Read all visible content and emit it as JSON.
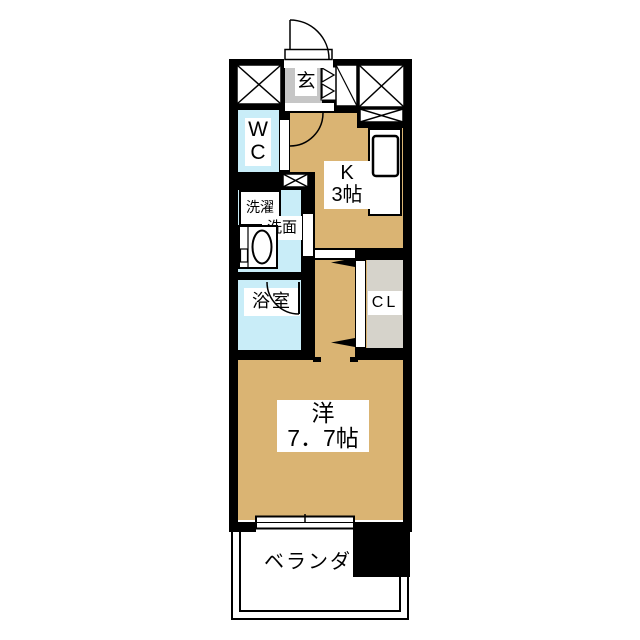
{
  "title": "1K apartment floor plan",
  "colors": {
    "floor": "#DAB473",
    "wet": "#C9EDF8",
    "genkan": "#C6C6C6",
    "closet": "#D6D3CB",
    "wall": "#000000",
    "bg": "#FFFFFF"
  },
  "rooms": {
    "entrance": {
      "label": "玄"
    },
    "wc": {
      "line1": "W",
      "line2": "C"
    },
    "laundry": {
      "label": "洗濯"
    },
    "washroom": {
      "label": "洗面"
    },
    "bathroom": {
      "label": "浴室"
    },
    "kitchen": {
      "line1": "K",
      "line2": "3帖"
    },
    "closet": {
      "label": "CL"
    },
    "main_room": {
      "line1": "洋",
      "line2": "7．7帖"
    },
    "veranda": {
      "label": "ベランダ"
    }
  }
}
